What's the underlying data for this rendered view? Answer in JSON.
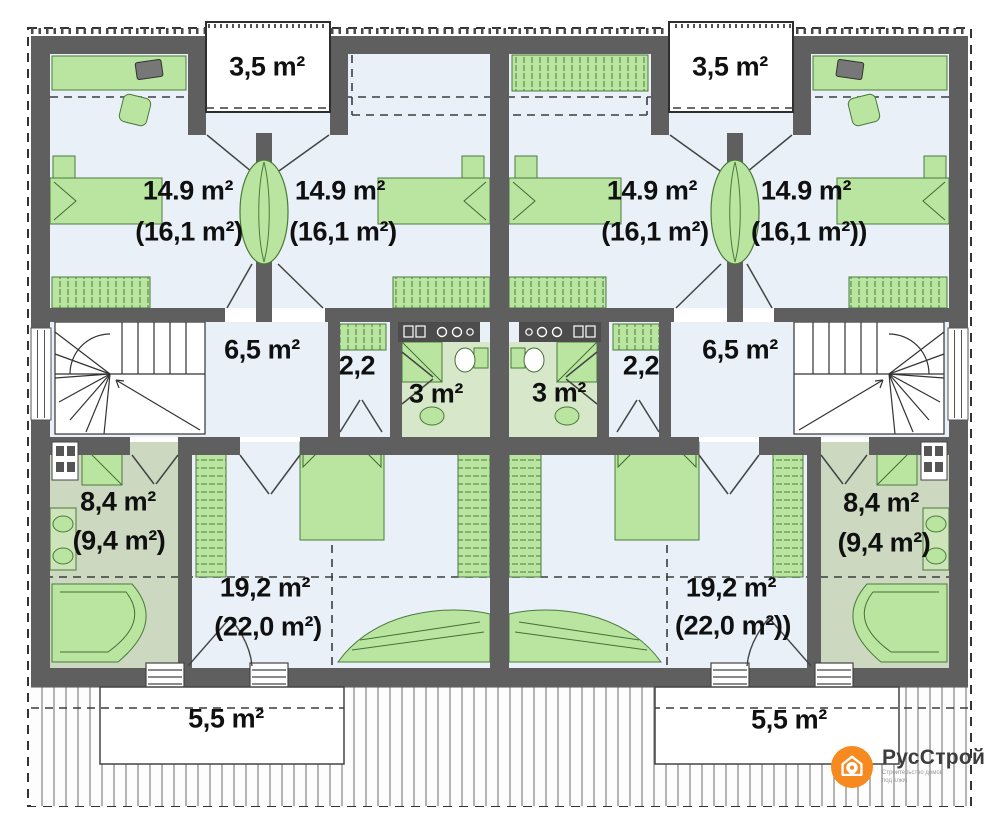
{
  "units": {
    "left": {
      "balcony_top": "3,5 m²",
      "bedroom_left": {
        "area": "14.9 m²",
        "area_with_slope": "(16,1 m²)"
      },
      "bedroom_right": {
        "area": "14.9 m²",
        "area_with_slope": "(16,1 m²)"
      },
      "hallway": "6,5 m²",
      "closet": "2,2",
      "bathroom_small": "3 m²",
      "bathroom": {
        "area": "8,4 m²",
        "area_with_slope": "(9,4 m²)"
      },
      "bedroom_main": {
        "area": "19,2 m²",
        "area_with_slope": "(22,0 m²)"
      },
      "terrace": "5,5 m²"
    },
    "right": {
      "balcony_top": "3,5 m²",
      "bedroom_left": {
        "area": "14.9 m²",
        "area_with_slope": "(16,1 m²)"
      },
      "bedroom_right": {
        "area": "14.9 m²",
        "area_with_slope": "(16,1 m²))"
      },
      "hallway": "6,5 m²",
      "closet": "2,2",
      "bathroom_small": "3 m²",
      "bathroom": {
        "area": "8,4 m²",
        "area_with_slope": "(9,4 m²)"
      },
      "bedroom_main": {
        "area": "19,2 m²",
        "area_with_slope": "(22,0 m²))"
      },
      "terrace": "5,5 m²"
    }
  },
  "logo": {
    "title": "РусСтрой",
    "tagline1": "Строительство домов",
    "tagline2": "под ключ"
  },
  "colors": {
    "accent": "#F6891F",
    "walls": "#5F5F5F",
    "furniture_green": "#B9E5A1",
    "room_fill": "#E9F0F8"
  }
}
